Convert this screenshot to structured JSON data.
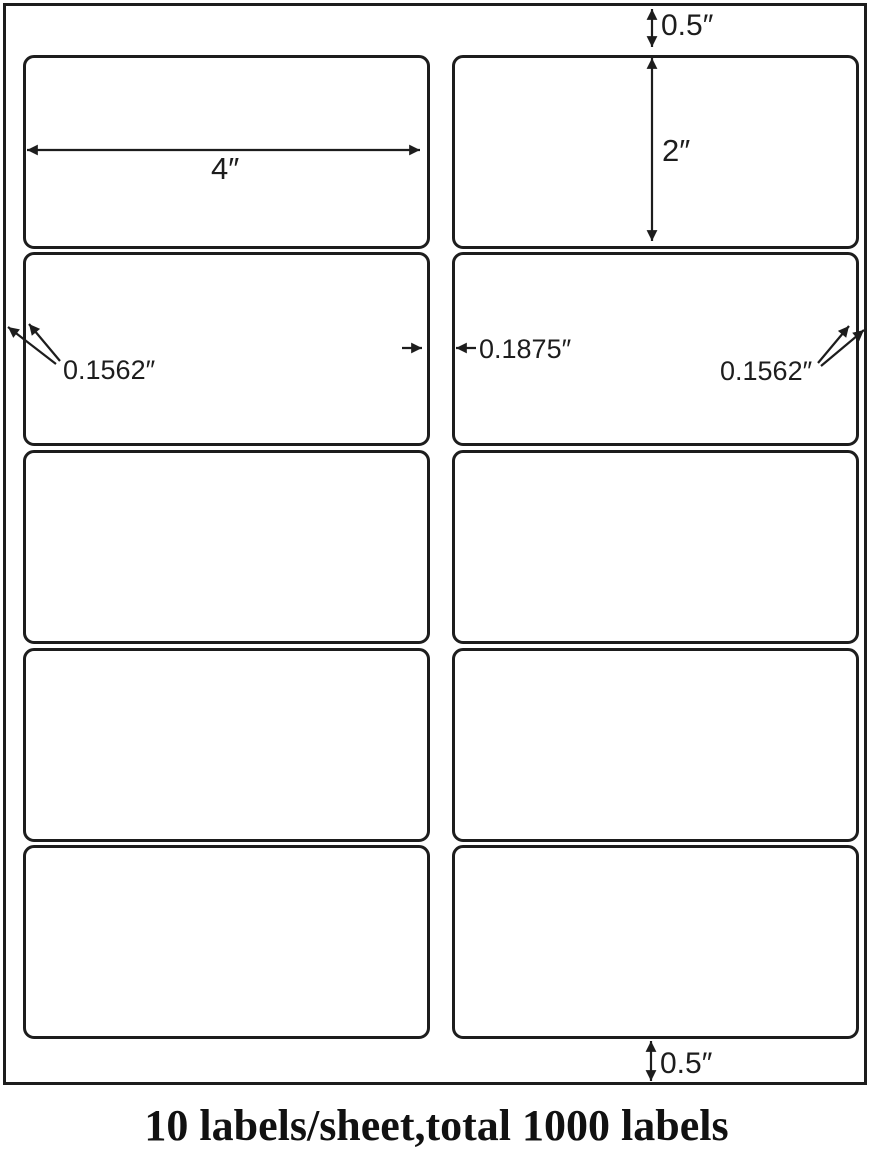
{
  "page": {
    "background_color": "#ffffff",
    "caption": "10 labels/sheet,total 1000 labels"
  },
  "sheet": {
    "columns": 2,
    "rows": 5,
    "labels_shown": 10,
    "line_color": "#1d1d1d",
    "fill_color": "#ffffff"
  },
  "dimensions": {
    "top_margin": "0.5″",
    "label_height": "2″",
    "label_width": "4″",
    "left_margin": "0.1562″",
    "column_gap": "0.1875″",
    "right_margin": "0.1562″",
    "bottom_margin": "0.5″"
  }
}
